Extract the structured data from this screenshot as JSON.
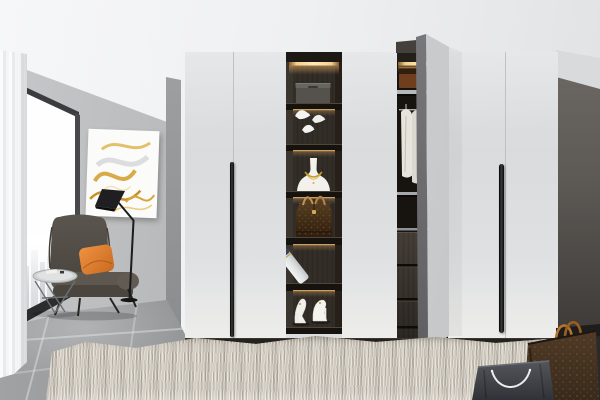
{
  "scene": {
    "type": "interior-photograph",
    "setting": "Modern dressing room with fitted white wardrobe, open display shelving, lounge corner with window",
    "lighting": "Daylight from the left window with warm LED strips inside the wardrobe shelving"
  },
  "objects": {
    "window": {
      "label": "floor-to-ceiling window with faint city view"
    },
    "curtain": {
      "label": "white sheer curtain"
    },
    "artwork": {
      "label": "abstract gold and white marble wall art"
    },
    "floor_lamp": {
      "label": "black angular floor lamp"
    },
    "armchair": {
      "label": "dark taupe wingback armchair"
    },
    "cushion": {
      "label": "orange throw cushion"
    },
    "side_table": {
      "label": "round wire-frame side table with small book"
    },
    "wardrobe": {
      "label": "white fitted wardrobe",
      "door_count": 6,
      "handle_style": "long black bar pulls",
      "open_door": "one door swung open"
    },
    "display_column": {
      "label": "dark wood open display column with warm LED strips",
      "items": [
        "translucent storage box",
        "three white origami bird figurines",
        "white jewelry bust with gold necklace",
        "brown monogram dome handbag",
        "leaning white cosmetic bottle with navy cap",
        "pair of ivory high-heel pumps"
      ]
    },
    "open_section": {
      "label": "open wardrobe bay",
      "contents": [
        "brown storage box on lit top shelf",
        "three white shirts hanging on rail",
        "dark wood drawer stack"
      ]
    },
    "rug": {
      "label": "beige shaggy area rug"
    },
    "floor": {
      "label": "gray concrete-look tile floor"
    },
    "bag_brown": {
      "label": "brown monogram shopping bag with tan handles"
    },
    "bag_gray": {
      "label": "gray shopping bag with white rope handles"
    }
  },
  "palette": {
    "ceiling": "#f3f4f6",
    "wall-left": "#c6c8ca",
    "wall-right": "#746f6b",
    "door-white": "#e2e4e6",
    "kick": "#24221f",
    "floor-gray": "#a4a6a8",
    "rug": "#cfc8bc",
    "cabinet-dark": "#2f2a25",
    "led-warm": "#f4cf8d",
    "gold": "#c49a2b",
    "pillow-orange": "#ef9140",
    "chair-brown": "#55504a",
    "bag-brown": "#46331f",
    "handle-black": "#0a0a0a",
    "shirt-white": "#e7e4dc"
  }
}
